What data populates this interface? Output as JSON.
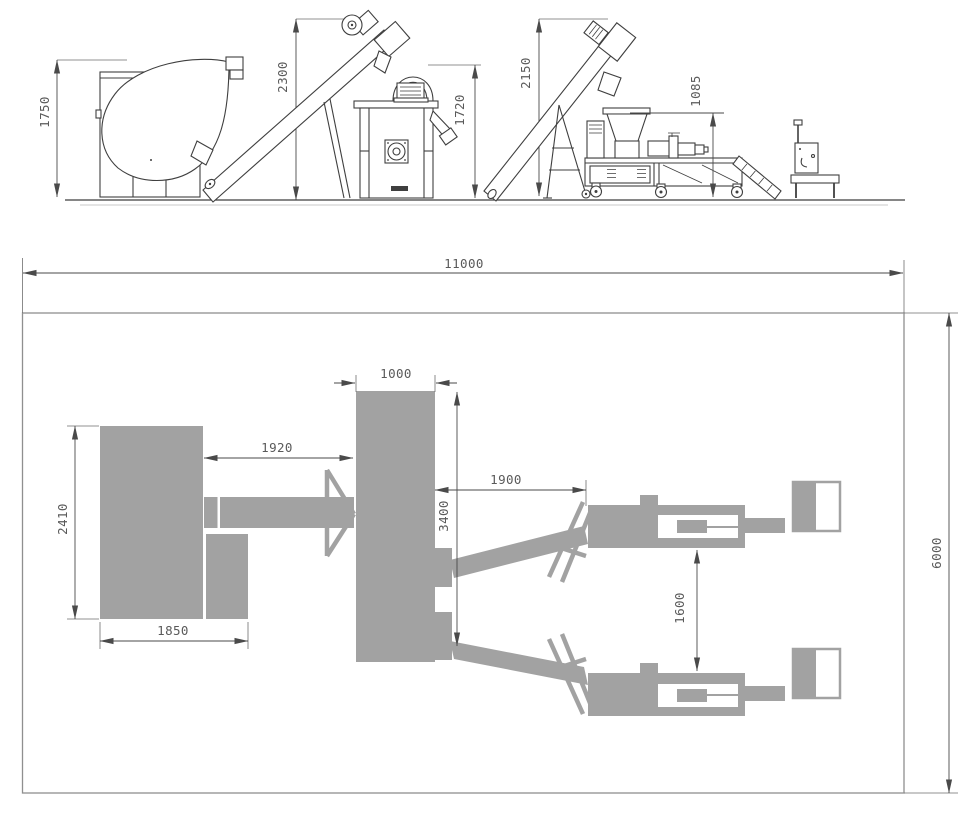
{
  "elevation": {
    "dim_mixer_height": "1750",
    "dim_conveyor1_top": "2300",
    "dim_cabinet_height": "1720",
    "dim_conveyor2_top": "2150",
    "dim_extruder_infeed_height": "1085"
  },
  "plan": {
    "dim_overall_length": "11000",
    "dim_overall_width": "6000",
    "dim_extruder_block_width": "1000",
    "dim_gap_mixer_to_extruder": "1920",
    "dim_mixer_depth": "2410",
    "dim_extruder_block_length": "3400",
    "dim_gap_extruder_to_line": "1900",
    "dim_line_spacing": "1600",
    "dim_mixer_width": "1850"
  },
  "colors": {
    "machine_gray": "#a2a2a2",
    "drawing_line": "#3f3f3f",
    "dimension_line": "#4a4a4a",
    "dimension_text": "#5a5a5a",
    "plan_border": "#8f8f8f",
    "background": "#ffffff"
  }
}
